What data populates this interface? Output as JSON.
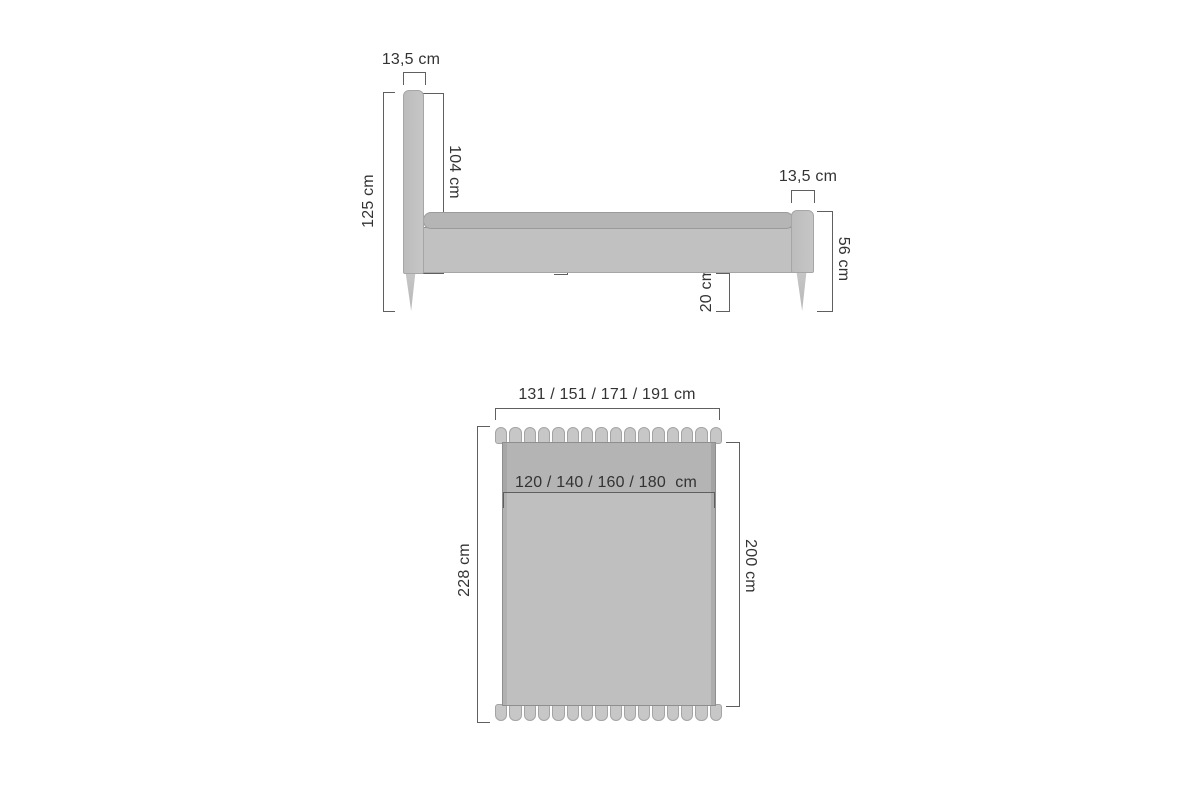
{
  "diagram": {
    "side_view": {
      "headboard_thickness": "13,5 cm",
      "total_height": "125 cm",
      "headboard_panel_height": "104 cm",
      "frame_height": "26 cm",
      "floor_clearance": "20 cm",
      "footboard_thickness": "13,5 cm",
      "footboard_height": "56 cm"
    },
    "top_view": {
      "overall_width": "131 / 151 / 171 / 191 cm",
      "mattress_width": "120 / 140 / 160 / 180  cm",
      "overall_length": "228 cm",
      "mattress_length": "200 cm",
      "headboard_slat_count": 16,
      "footboard_slat_count": 16
    },
    "colors": {
      "background": "#ffffff",
      "bed_fill": "#c1c1c1",
      "mattress_fill": "#b5b5b5",
      "slat_fill": "#c7c7c7",
      "dimension_line": "#5f5f5f",
      "label_text": "#333333"
    }
  }
}
